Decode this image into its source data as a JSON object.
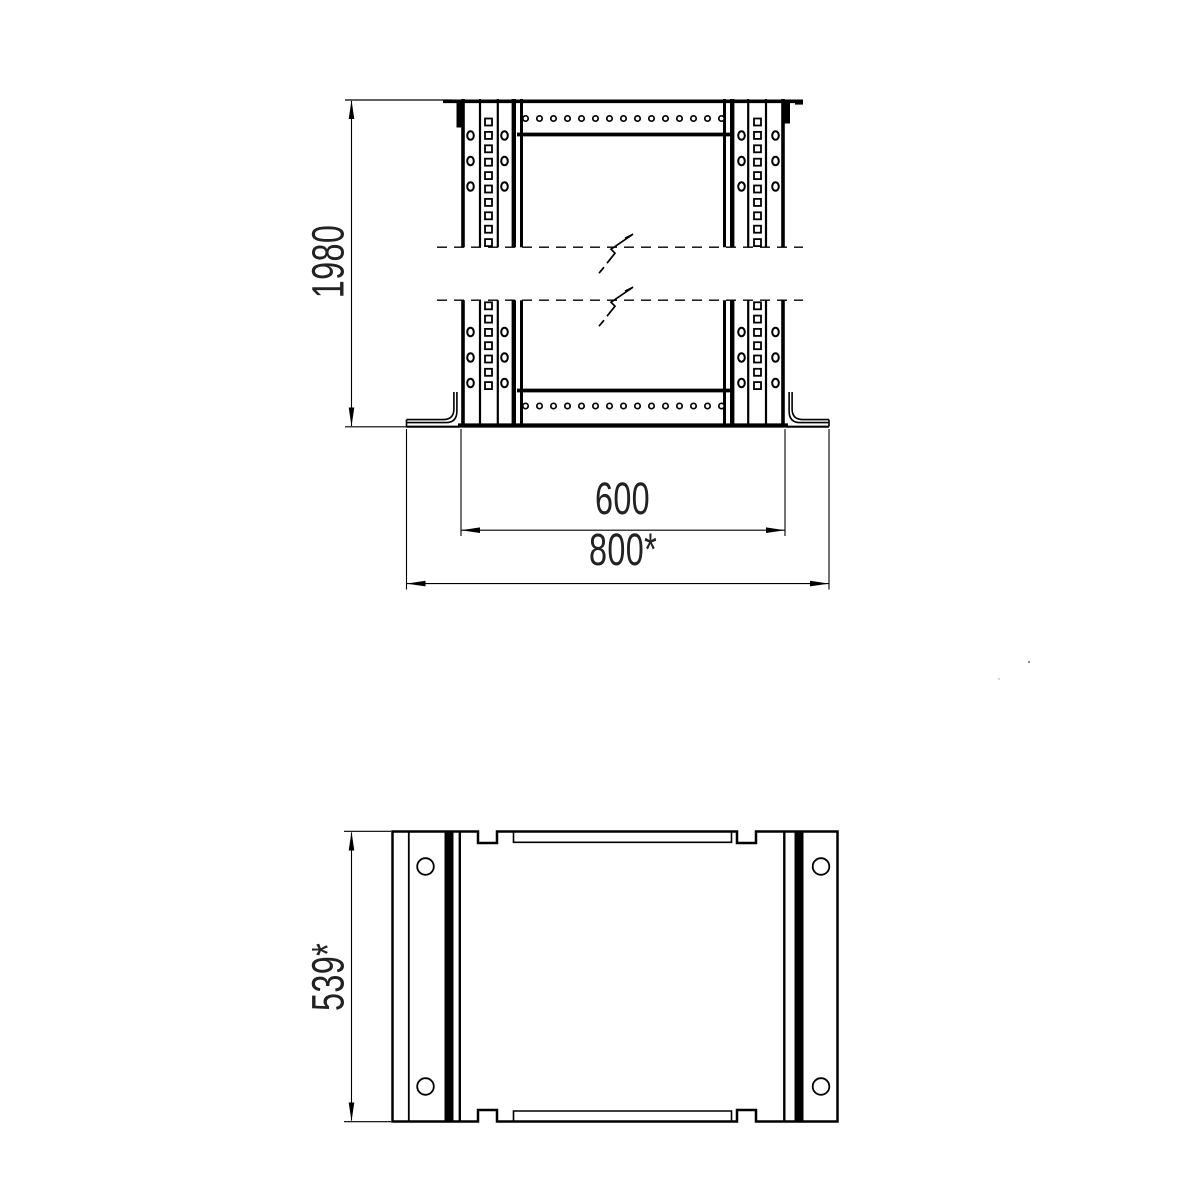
{
  "drawing": {
    "type": "technical_drawing",
    "description": "Rack frame: front elevation with break lines and bottom plan view",
    "colors": {
      "line": "#000000",
      "background": "#ffffff",
      "text": "#222222"
    }
  },
  "views": {
    "front": {
      "dimensions": {
        "height": "1980",
        "rail_spacing": "600",
        "overall_width": "800*"
      },
      "panel_hole_rows": {
        "top_count": 15,
        "bottom_count": 15
      },
      "rail_square_holes": {
        "upper_section": 10,
        "lower_section": 7
      },
      "rail_oval_holes_per_column_per_section": 3,
      "oval_hole_columns": 4,
      "break_lines": 2
    },
    "plan": {
      "dimensions": {
        "depth": "539*"
      },
      "corner_holes": 4,
      "top_notches": 2,
      "bottom_notches": 2
    }
  }
}
